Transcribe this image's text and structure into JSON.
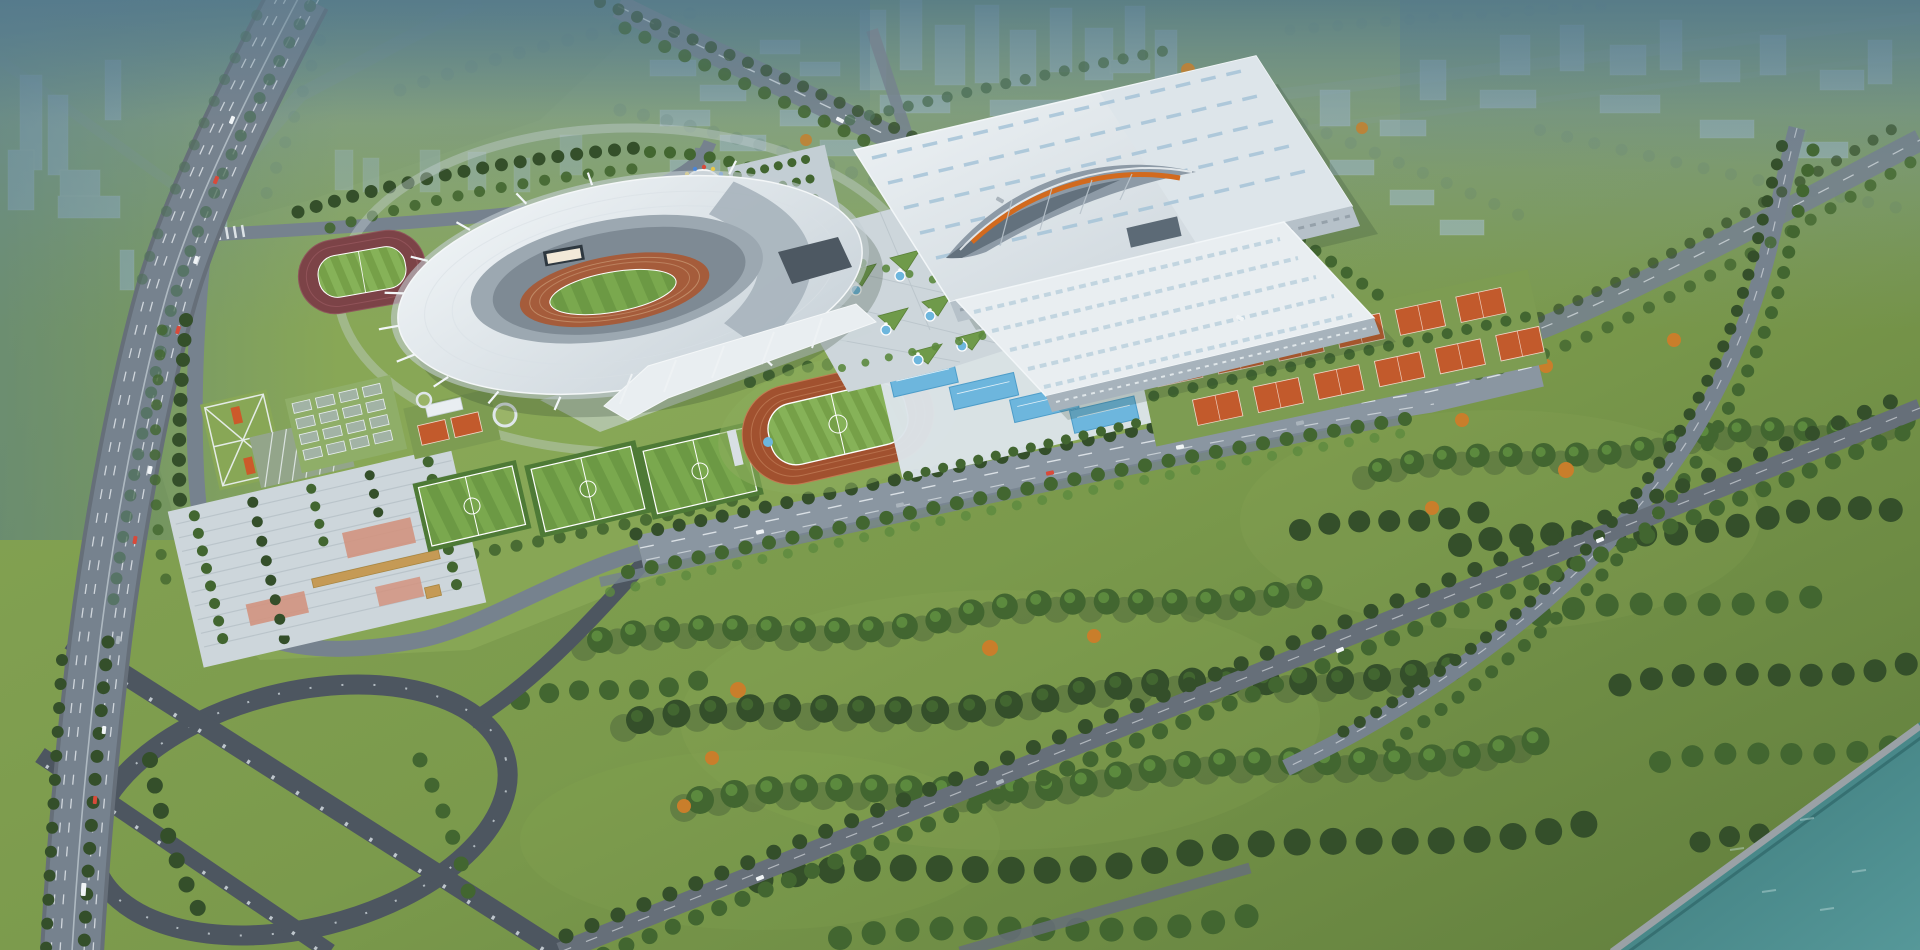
{
  "scene": {
    "type": "aerial-architectural-rendering",
    "subject": "sports-complex",
    "soccer_fields": 3,
    "running_tracks": 3,
    "tennis_courts": 12,
    "outdoor_pools": 4,
    "basketball_courts": 16,
    "has_river": true,
    "has_highway_interchange": true
  },
  "colors": {
    "haze_top": "#54798e",
    "haze_soft": "#7e9aa8",
    "city_block": "#a9c2ce",
    "city_tree": "#4e6f58",
    "grass_campus": "#88a756",
    "grass_park": "#7b9a4c",
    "grass_light": "#95b161",
    "grass_dark": "#617e3d",
    "tree_dark": "#344f2a",
    "tree_mid": "#426630",
    "tree_light": "#5c8a3e",
    "tree_autumn": "#c97e2b",
    "road": "#76828e",
    "road_light": "#8a96a1",
    "road_dark": "#666f79",
    "marking": "#eef3f6",
    "ramp": "#4d5660",
    "pillar": "#ccd4d9",
    "roof_white": "#e9eef1",
    "roof_shade": "#c6d0d7",
    "roof_edge": "#a2afb9",
    "roof_panel_dark": "#a8b4bd",
    "stands": "#9ca8b1",
    "stands_dark": "#7e8a94",
    "track_main": "#a55c3b",
    "track_practice": "#7c4347",
    "track_small": "#a1512f",
    "track_lane": "#c08a66",
    "field_a": "#7aa84e",
    "field_b": "#6c9944",
    "line_white": "#ffffff",
    "pool_deck": "#dce4e9",
    "pool_water": "#6db6dd",
    "pool_water_dark": "#4e9dc9",
    "tennis": "#c25a2c",
    "tennis_line": "#f0d8cb",
    "court_gray": "#a2b3a5",
    "plaza": "#cdd6db",
    "plaza_line": "#b8c3c9",
    "plaza_accent": "#d2937f",
    "pavilion": "#c59a55",
    "steel": "#8d9aa6",
    "arch_orange": "#d26a1e",
    "screen": "#f2e9d8",
    "screen_frame": "#2e3840",
    "water_deep": "#3a7778",
    "water_light": "#569899",
    "bank": "#9aa1a6",
    "car_red": "#d84a3a",
    "car_white": "#f0f4f6",
    "car_dark": "#aab4bc",
    "flag_red": "#d84a3a",
    "flag_yellow": "#e8c84a",
    "flag_blue": "#4a86d8",
    "shadow": "#2f4430"
  }
}
